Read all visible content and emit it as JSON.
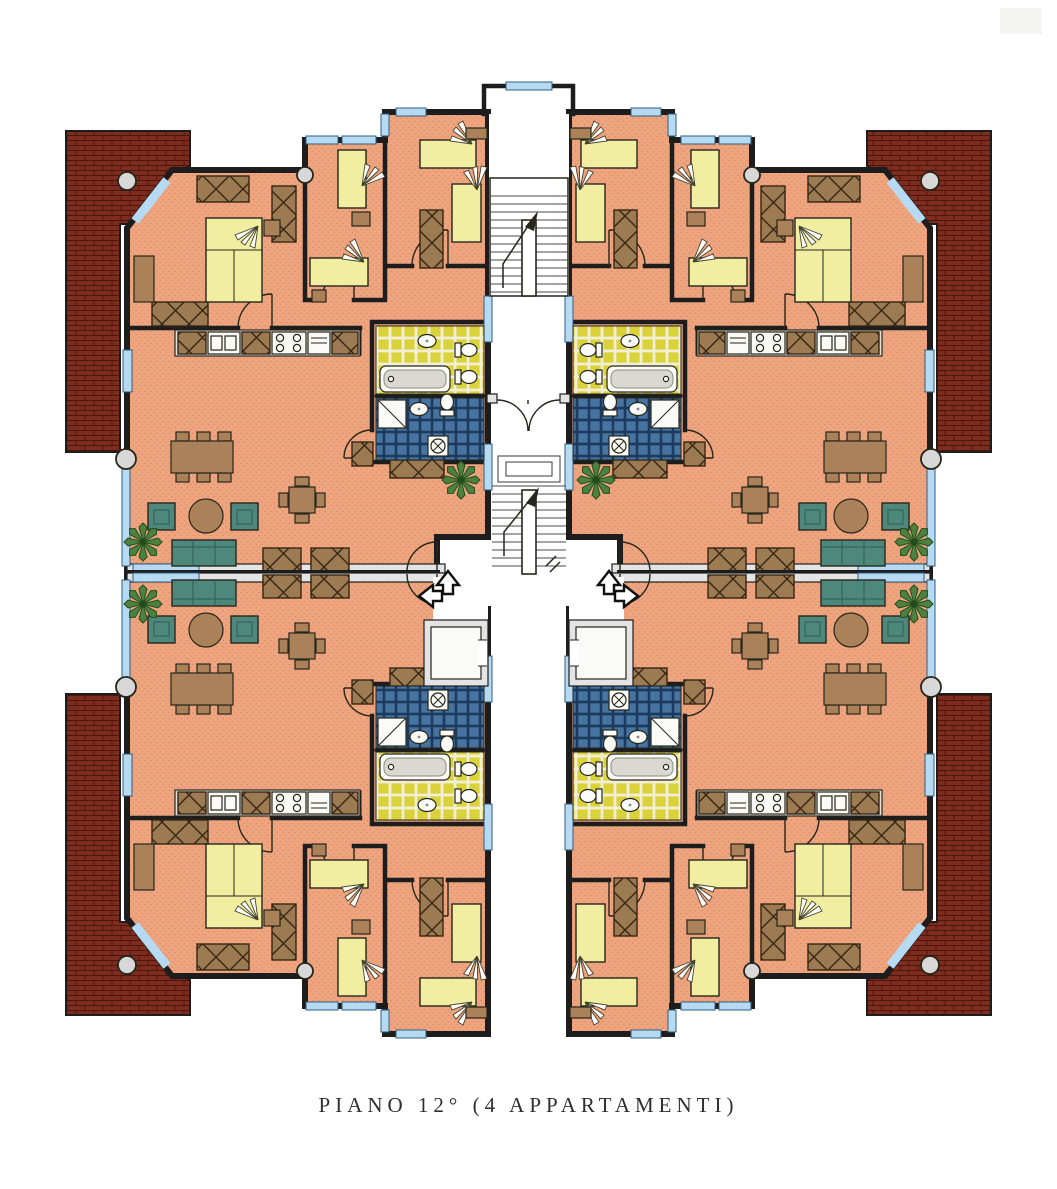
{
  "caption": {
    "text": "PIANO 12° (4 APPARTAMENTI)"
  },
  "plan": {
    "floor_label": "12°",
    "apartment_count": 4,
    "core": {
      "staircases": 2,
      "elevators": 2,
      "entrance_double_door": true,
      "direction_arrows": 4
    },
    "legend": [
      {
        "element": "apartment-floor",
        "color": "#eea57f"
      },
      {
        "element": "roof-brick-terrace",
        "color": "#7c2d20"
      },
      {
        "element": "bed",
        "color": "#f1eda1"
      },
      {
        "element": "wardrobe-x-box",
        "color": "#9c7a52"
      },
      {
        "element": "sofa-armchair",
        "color": "#4e877c"
      },
      {
        "element": "table-desk",
        "color": "#ab8159"
      },
      {
        "element": "bathroom-tiles-yellow",
        "color": "#d9d23b"
      },
      {
        "element": "bathroom-tiles-blue",
        "color": "#46739f"
      },
      {
        "element": "window-glass",
        "color": "#b5daf2"
      },
      {
        "element": "plant",
        "color": "#4c813f"
      }
    ]
  },
  "theme": {
    "colors": {
      "ink": "#2f2f2f",
      "inkDark": "#26261c",
      "wallEdge": "#1d1d1d",
      "wallFill": "#e4e4e4",
      "floor": "#eea57f",
      "floorDot": "#d88a5e",
      "brickRed": "#7c2d20",
      "brickLine": "#511508",
      "windowBlue": "#b5daf2",
      "windowEdge": "#2e5d80",
      "bedYellow": "#f1eda1",
      "furnBrown": "#ab8159",
      "wrdBrown": "#9c7a52",
      "wrdLine": "#362613",
      "sofaTeal": "#4e877c",
      "sofaDark": "#2f5c53",
      "tileYellow": "#d9d23b",
      "tileYGrout": "#f3efd6",
      "tileBlue": "#46739f",
      "tileBGrout": "#1b3a5d",
      "fixWhite": "#fafaf6",
      "counter": "#e3e3dc",
      "stairLine": "#4a4a4a",
      "plantGreen": "#4c813f",
      "plantDark": "#234c1c"
    }
  }
}
